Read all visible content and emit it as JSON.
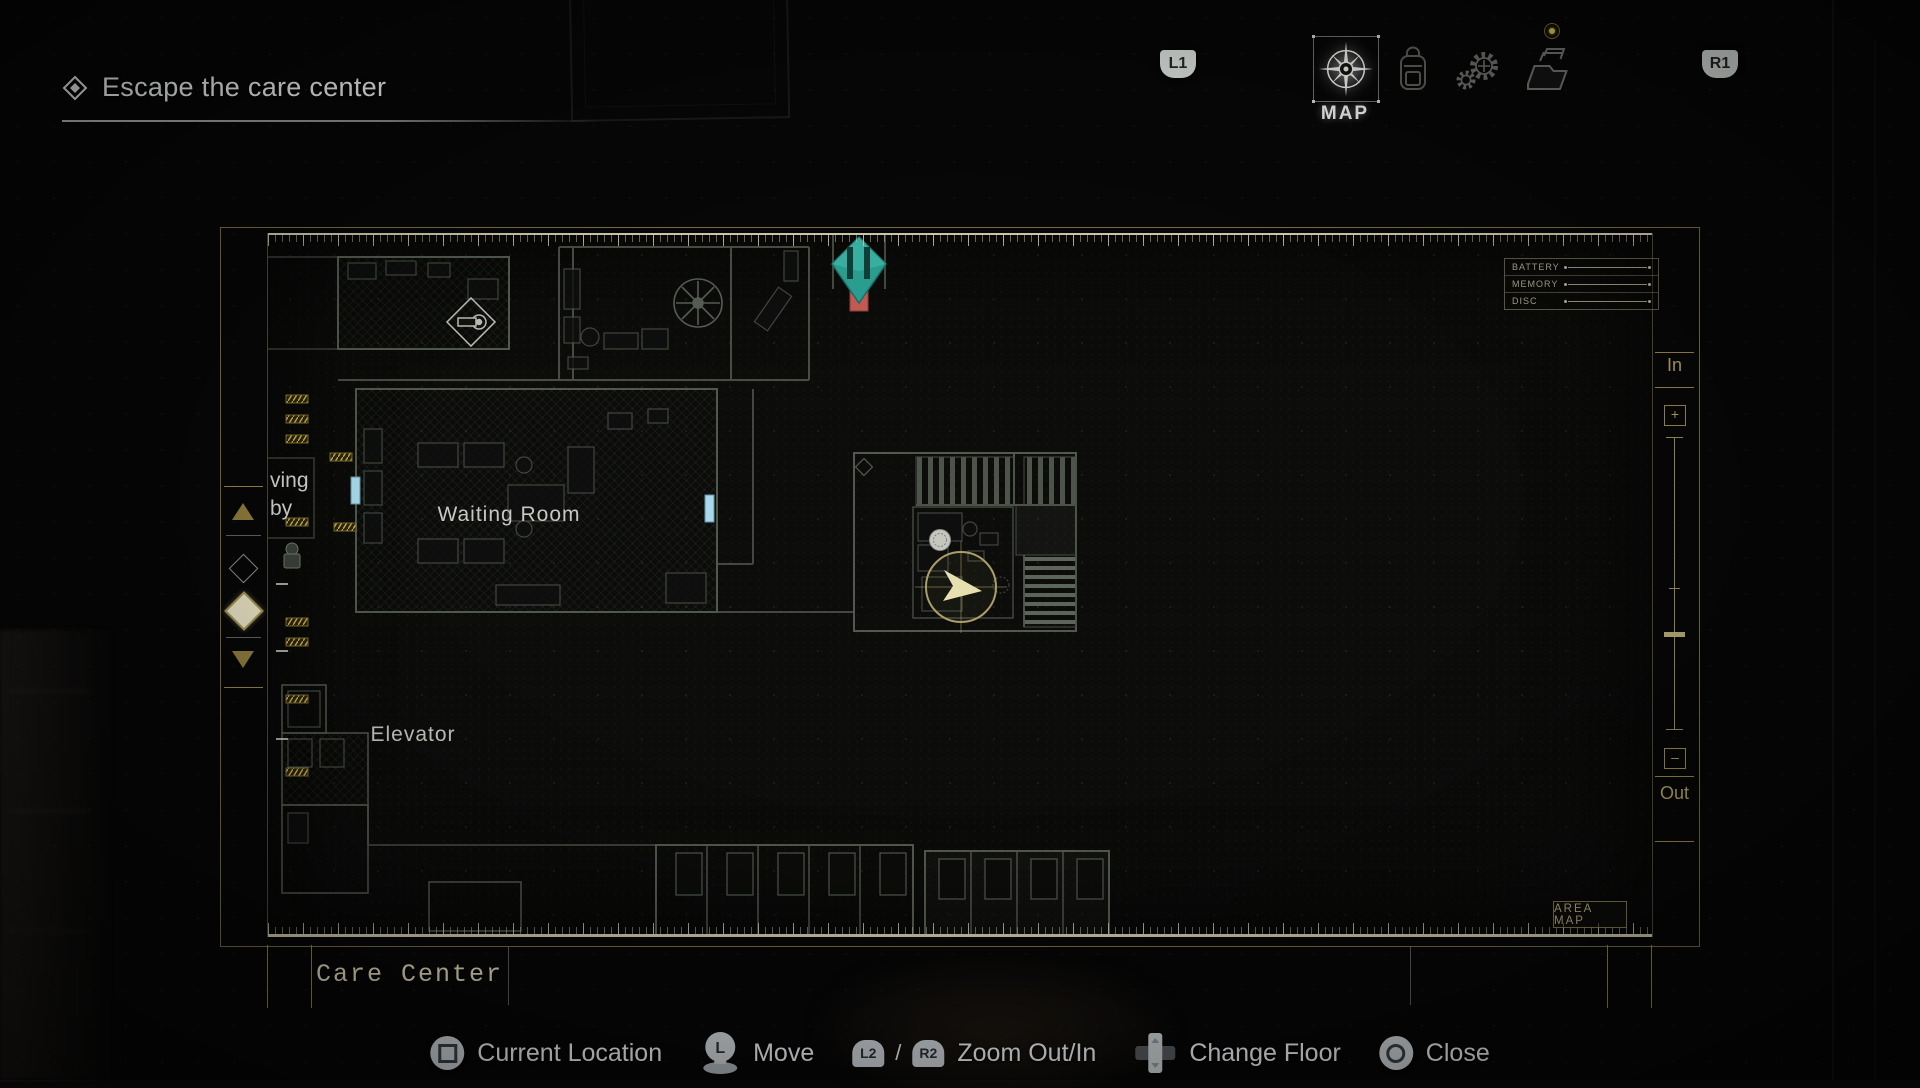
{
  "objective": {
    "label": "Escape the care center"
  },
  "topbar": {
    "l1_label": "L1",
    "r1_label": "R1",
    "tabs": [
      {
        "id": "map",
        "label": "MAP",
        "icon": "compass-icon",
        "selected": true
      },
      {
        "id": "inventory",
        "icon": "backpack-icon",
        "selected": false
      },
      {
        "id": "crafting",
        "icon": "gears-icon",
        "selected": false
      },
      {
        "id": "files",
        "icon": "folder-icon",
        "selected": false,
        "notification": true
      }
    ]
  },
  "map_panel": {
    "area_name": "Care Center",
    "area_map_button": "AREA MAP",
    "status_panel": {
      "rows": [
        {
          "label": "BATTERY"
        },
        {
          "label": "MEMORY"
        },
        {
          "label": "DISC"
        }
      ]
    },
    "zoom_control": {
      "in_label": "In",
      "plus": "+",
      "minus": "–",
      "out_label": "Out"
    },
    "labels": {
      "waiting_room": "Waiting Room",
      "elevator": "Elevator",
      "clipped_room_line1": "ving",
      "clipped_room_line2": "by"
    },
    "markers": {
      "objective_door": "teal-diamond-marker",
      "locked_door": "red-door-marker",
      "door": "cyan-door-marker",
      "player": "player-location-marker",
      "item": "coin-item-marker"
    },
    "colors": {
      "frame_gold": "#9d8c52",
      "marker_teal": "#2a9d91",
      "marker_red": "#c05a52",
      "door_cyan": "#a8d8ea",
      "player_arrow": "#e8dfb0"
    }
  },
  "controls": [
    {
      "icon": "square-button-icon",
      "label": "Current Location"
    },
    {
      "icon": "left-stick-icon",
      "stick_letter": "L",
      "label": "Move"
    },
    {
      "icon": "trigger-buttons-icon",
      "l2_label": "L2",
      "separator": "/",
      "r2_label": "R2",
      "label": "Zoom Out/In"
    },
    {
      "icon": "dpad-icon",
      "label": "Change Floor"
    },
    {
      "icon": "circle-button-icon",
      "label": "Close"
    }
  ]
}
